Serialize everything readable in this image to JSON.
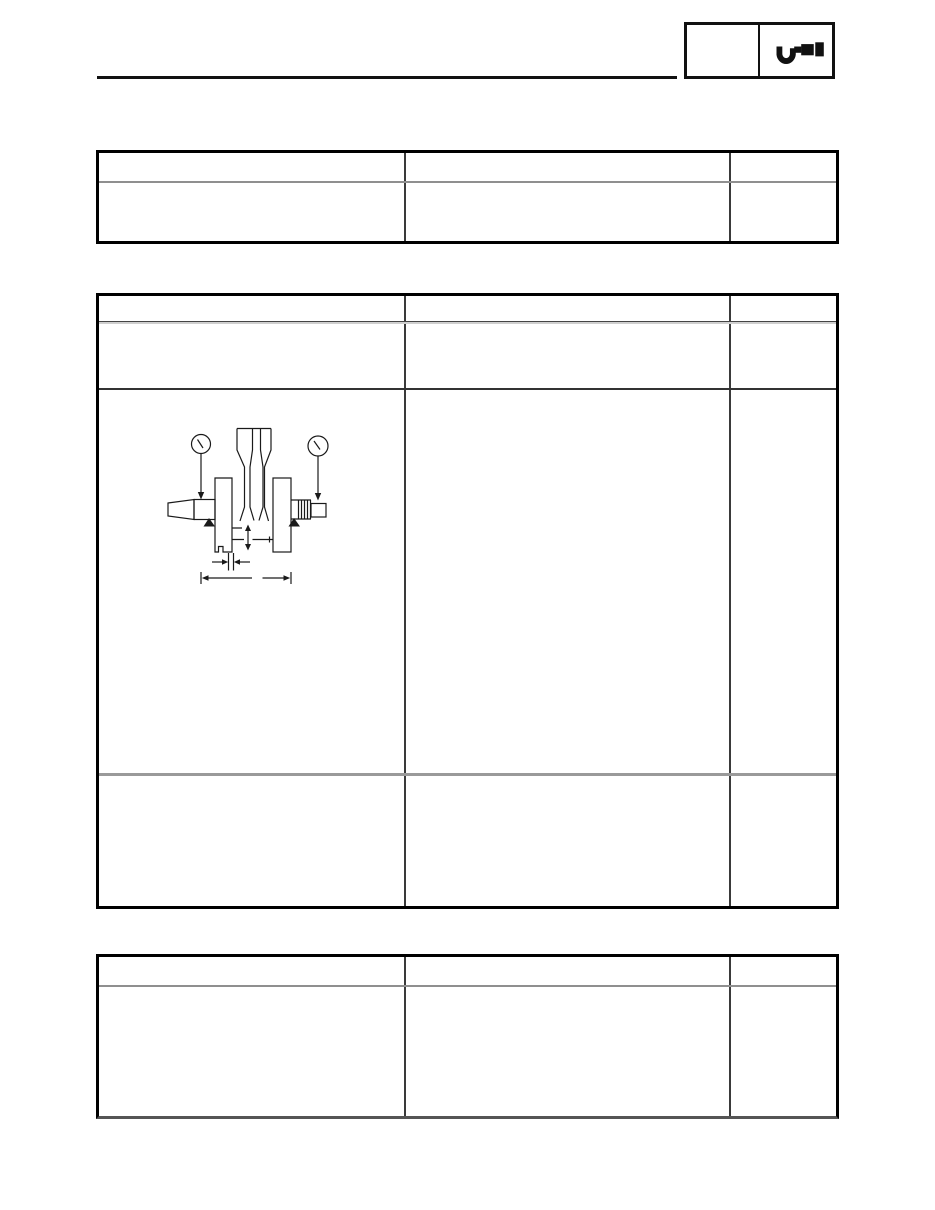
{
  "page": {
    "kind": "service-manual-specification-page",
    "background": "#ffffff",
    "ink": "#111111"
  },
  "header": {
    "rule_present": true,
    "chapter_box": {
      "left_cell_text": "",
      "right_cell_icon": "micrometer-icon"
    }
  },
  "tables": [
    {
      "name": "spec-table-1",
      "header": [
        "",
        "",
        ""
      ],
      "rows": [
        [
          "",
          "",
          ""
        ]
      ]
    },
    {
      "name": "spec-table-2",
      "header": [
        "",
        "",
        ""
      ],
      "rows": [
        [
          "",
          "",
          ""
        ],
        [
          "",
          "",
          ""
        ],
        [
          "",
          "",
          ""
        ]
      ],
      "diagram_row": 1
    },
    {
      "name": "spec-table-3",
      "header": [
        "",
        "",
        ""
      ],
      "rows": [
        [
          "",
          "",
          ""
        ]
      ]
    }
  ],
  "diagram": {
    "name": "crankshaft-runout-measurement",
    "elements": [
      "dial-gauge-left",
      "dial-gauge-right",
      "crankshaft-tapered-end",
      "crank-web-left",
      "crank-web-right",
      "connecting-rod",
      "splined-shaft-end",
      "support-point-left",
      "support-point-right",
      "big-end-side-clearance-arrow",
      "runout-point-dimension",
      "overall-width-dimension"
    ]
  },
  "colors": {
    "outer_border": "#000000",
    "column_divider": "#3a3a3a",
    "header_divider": "#8f8f8f",
    "row_divider_dark": "#333333",
    "row_divider_light": "#9a9a9a"
  }
}
